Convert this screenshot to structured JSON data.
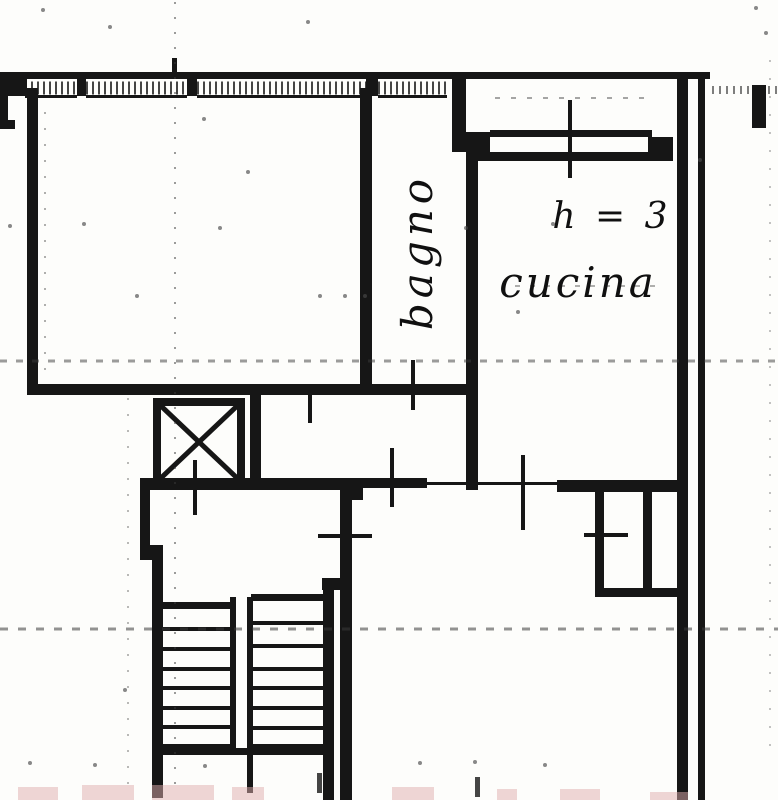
{
  "document": {
    "kind": "scanned cadastral floor plan extract"
  },
  "colors": {
    "paper": "#fdfdfb",
    "wall": "#161616",
    "dash": "#3a3a3a",
    "smudge": "#dfaeae"
  },
  "labels": {
    "bathroom": "bagno",
    "kitchen": "cucina",
    "kitchen_height": "h = 3"
  },
  "icons": [
    "elevator-x-icon",
    "stair-treads",
    "window-hatch",
    "door-opening-tick"
  ]
}
